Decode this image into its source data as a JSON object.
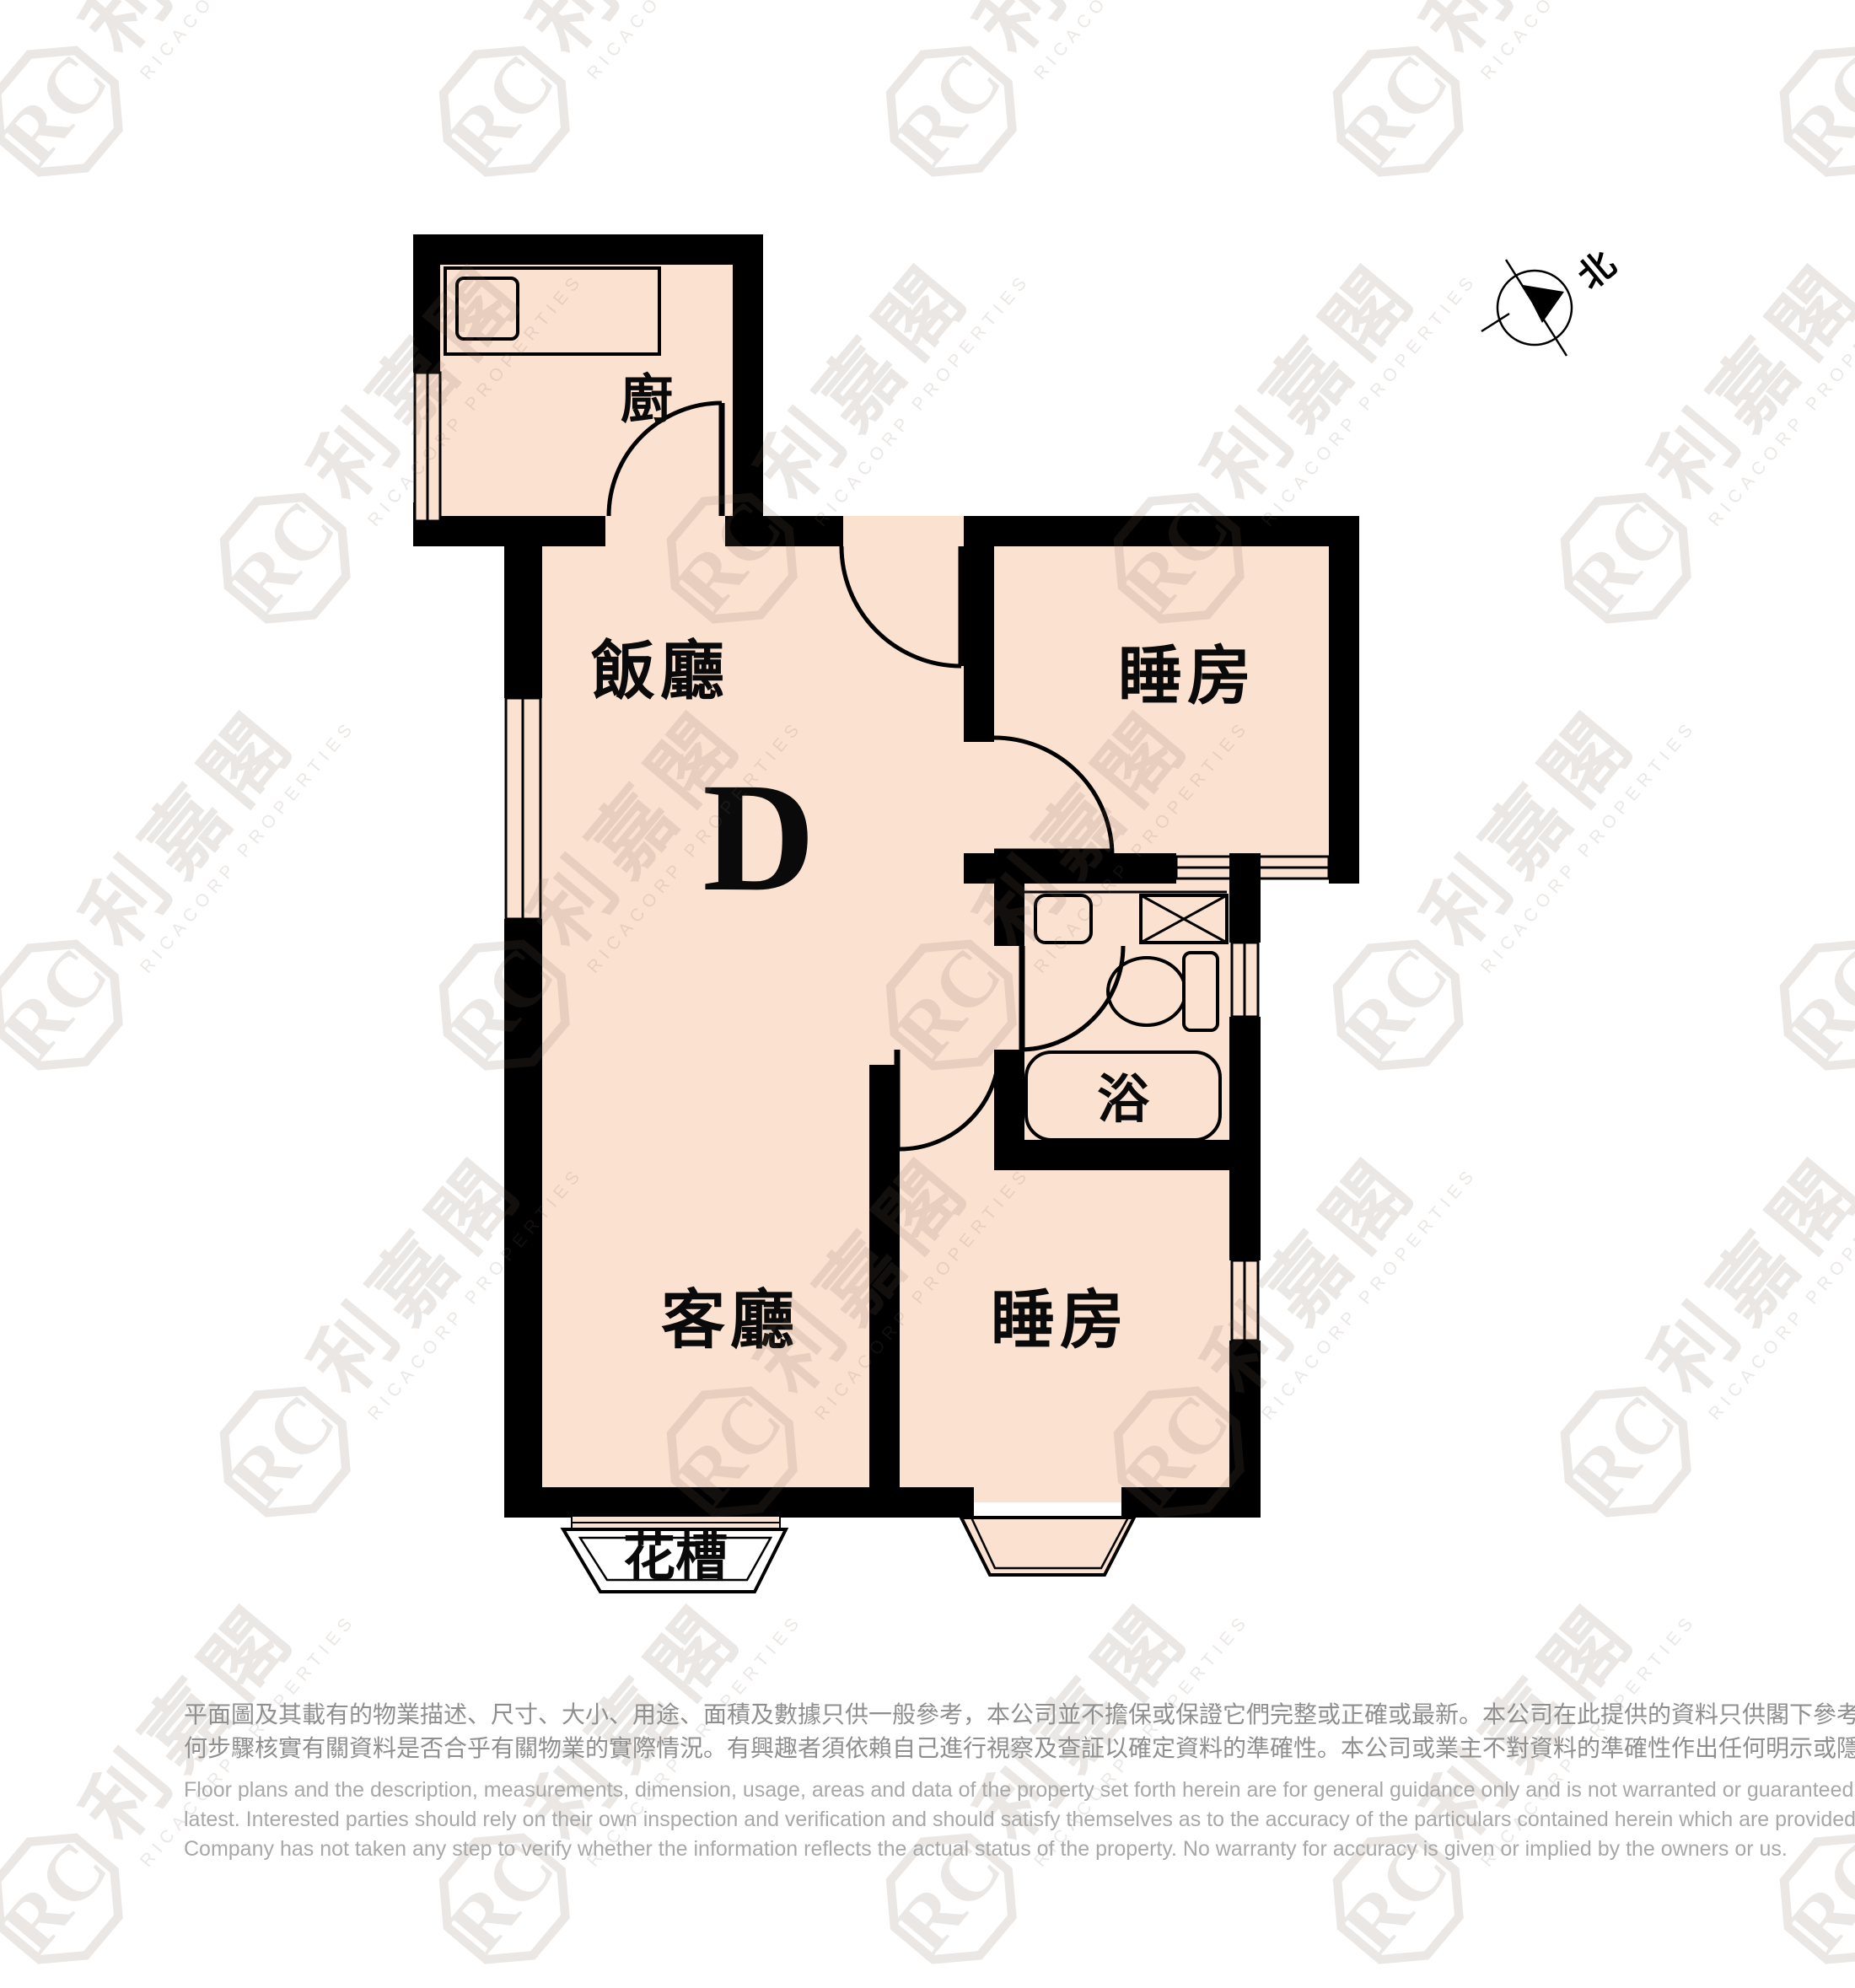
{
  "plan": {
    "unit_label": "D",
    "rooms": {
      "kitchen": "廚",
      "dining": "飯廳",
      "bedroom_top": "睡房",
      "bath": "浴",
      "living": "客廳",
      "bedroom_bottom": "睡房",
      "planter": "花槽"
    },
    "compass": {
      "north": "北"
    },
    "colors": {
      "floor": "#fbe1d0",
      "wall": "#000000",
      "planter_fill": "#ffffff"
    }
  },
  "watermark": {
    "logo_initials": "RC",
    "cn": "利嘉閣",
    "en": "RICACORP PROPERTIES"
  },
  "disclaimer": {
    "cn1": "平面圖及其載有的物業描述、尺寸、大小、用途、面積及數據只供一般參考，本公司並不擔保或保證它們完整或正確或最新。本公司在此提供的資料只供閣下參考，本公司並無採取任",
    "cn2": "何步驟核實有關資料是否合乎有關物業的實際情況。有興趣者須依賴自己進行視察及查証以確定資料的準確性。本公司或業主不對資料的準確性作出任何明示或隱含的保證。",
    "en1": "Floor plans and the description, measurements, dimension, usage, areas and data of the property set forth herein are for general guidance only and is not warranted or guaranteed to be complete or correct or the",
    "en2": "latest. Interested parties should rely on their own inspection and verification and should satisfy themselves as to the accuracy of the particulars contained herein which are provided by us for information only.  Our",
    "en3": "Company has not taken any step to verify whether the information reflects the actual status of the property.  No warranty for accuracy is given or implied by the owners or us."
  }
}
